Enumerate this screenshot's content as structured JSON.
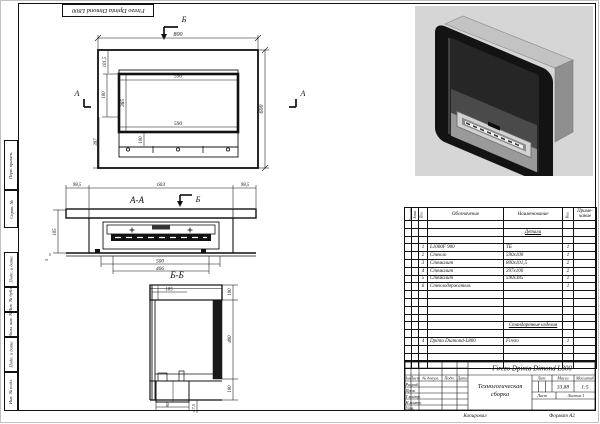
{
  "margin": {
    "corner_stamp": "Firezo Dpinta Dimond L800",
    "copied": "Копировал",
    "format": "Формат А2",
    "stamps": [
      "Перв. примен.",
      "Справ. №",
      "Подп. и дата",
      "Инв. № дубл.",
      "Взам. инв. №",
      "Подп. и дата",
      "Инв. № подл."
    ]
  },
  "front_view": {
    "dim_width": "800",
    "dim_top_strip": "101,5",
    "dim_window_top": "590",
    "dim_window_height": "385",
    "dim_window_bottom": "590",
    "dim_burner": "100",
    "dim_left_upper": "180",
    "dim_left_lower": "397",
    "dim_height": "600",
    "marker_a": "А",
    "marker_b": "Б"
  },
  "section_aa": {
    "label": "А-А",
    "marker_b": "Б",
    "dim_left": "98,5",
    "dim_center": "603",
    "dim_right": "98,5",
    "dim_depth": "185",
    "dim_gap": "5",
    "dim_outer": "500",
    "dim_inner": "406"
  },
  "section_bb": {
    "label": "Б-Б",
    "dim_top": "185",
    "dim_right_top": "100",
    "dim_right_mid": "400",
    "dim_right_bottom": "100",
    "dim_bottom": "90",
    "dim_offset": "47,5"
  },
  "bom": {
    "headers": {
      "format": "Формат",
      "zone": "Зона",
      "pos": "Поз.",
      "designation": "Обозначение",
      "name": "Наименование",
      "qty": "Кол.",
      "note_l1": "Приме-",
      "note_l2": "чание"
    },
    "section_details": "Детали",
    "section_standard": "Стандартные изделия",
    "rows": [
      {
        "pos": "1",
        "designation": "L1000F 900",
        "name": "ТБ",
        "qty": "1"
      },
      {
        "pos": "2",
        "designation": "Стекло",
        "name": "590х100",
        "qty": "1"
      },
      {
        "pos": "3",
        "designation": "Стемалит",
        "name": "800х101,5",
        "qty": "2"
      },
      {
        "pos": "4",
        "designation": "Стемалит",
        "name": "397х100",
        "qty": "2"
      },
      {
        "pos": "5",
        "designation": "Стемалит",
        "name": "590х385",
        "qty": "1"
      },
      {
        "pos": "6",
        "designation": "Стеклодержатель",
        "name": "",
        "qty": "1"
      }
    ],
    "standard_row": {
      "pos": "4",
      "designation": "Dpinta Diamond-L800",
      "name": "Firezo",
      "qty": "1"
    }
  },
  "title_block": {
    "designation": "Firezo Dpinta Dimond L800",
    "doc_name_l1": "Технологическая",
    "doc_name_l2": "сборка",
    "mass": "33,88",
    "scale": "1:5",
    "labels": {
      "izm": "Изм",
      "list": "Лист",
      "doc": "№ докум.",
      "podp": "Подп.",
      "data": "Дата",
      "razrab": "Разраб.",
      "prov": "Пров.",
      "tkontr": "Т.контр.",
      "nkontr": "Н.контр.",
      "utv": "Утв.",
      "lit": "Лит.",
      "massa": "Масса",
      "masshtab": "Масштаб",
      "sheet": "Лист",
      "sheets": "Листов 1"
    }
  }
}
